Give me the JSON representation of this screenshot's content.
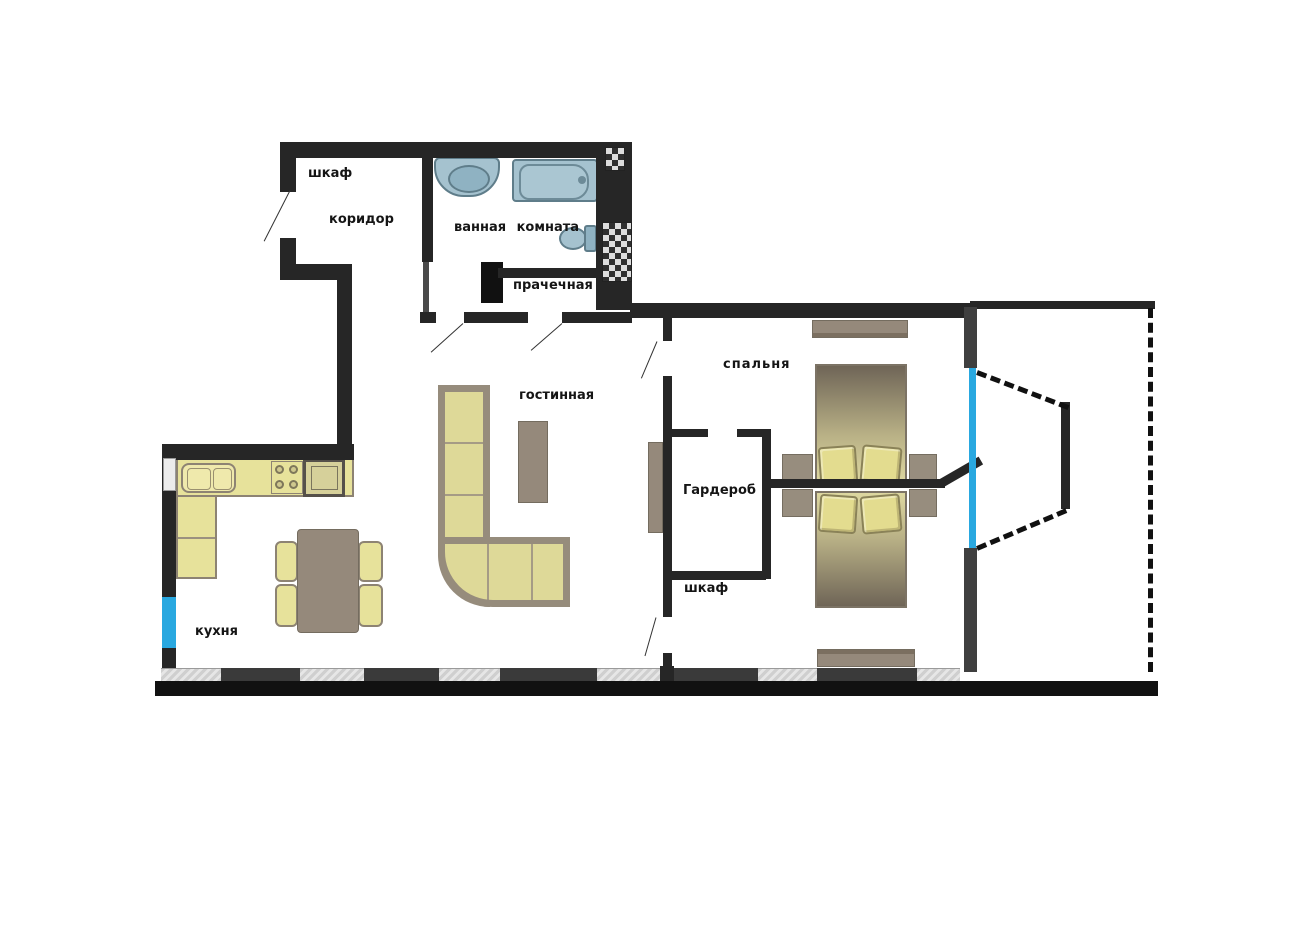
{
  "rooms": {
    "hall_closet": "шкаф",
    "corridor": "коридор",
    "bathroom": "ванная комната",
    "laundry": "прачечная",
    "living_room": "гостинная",
    "bedroom": "спальня",
    "wardrobe": "Гардероб",
    "bedroom_closet": "шкаф",
    "kitchen": "кухня"
  },
  "colors": {
    "wall": "#262626",
    "window": "#29a8e0",
    "furniture_yellow": "#e7e29b",
    "furniture_gray": "#95897b",
    "fixture_blue": "#a5c2cf",
    "window_sill": "#dcdcdc",
    "background": "#ffffff"
  }
}
